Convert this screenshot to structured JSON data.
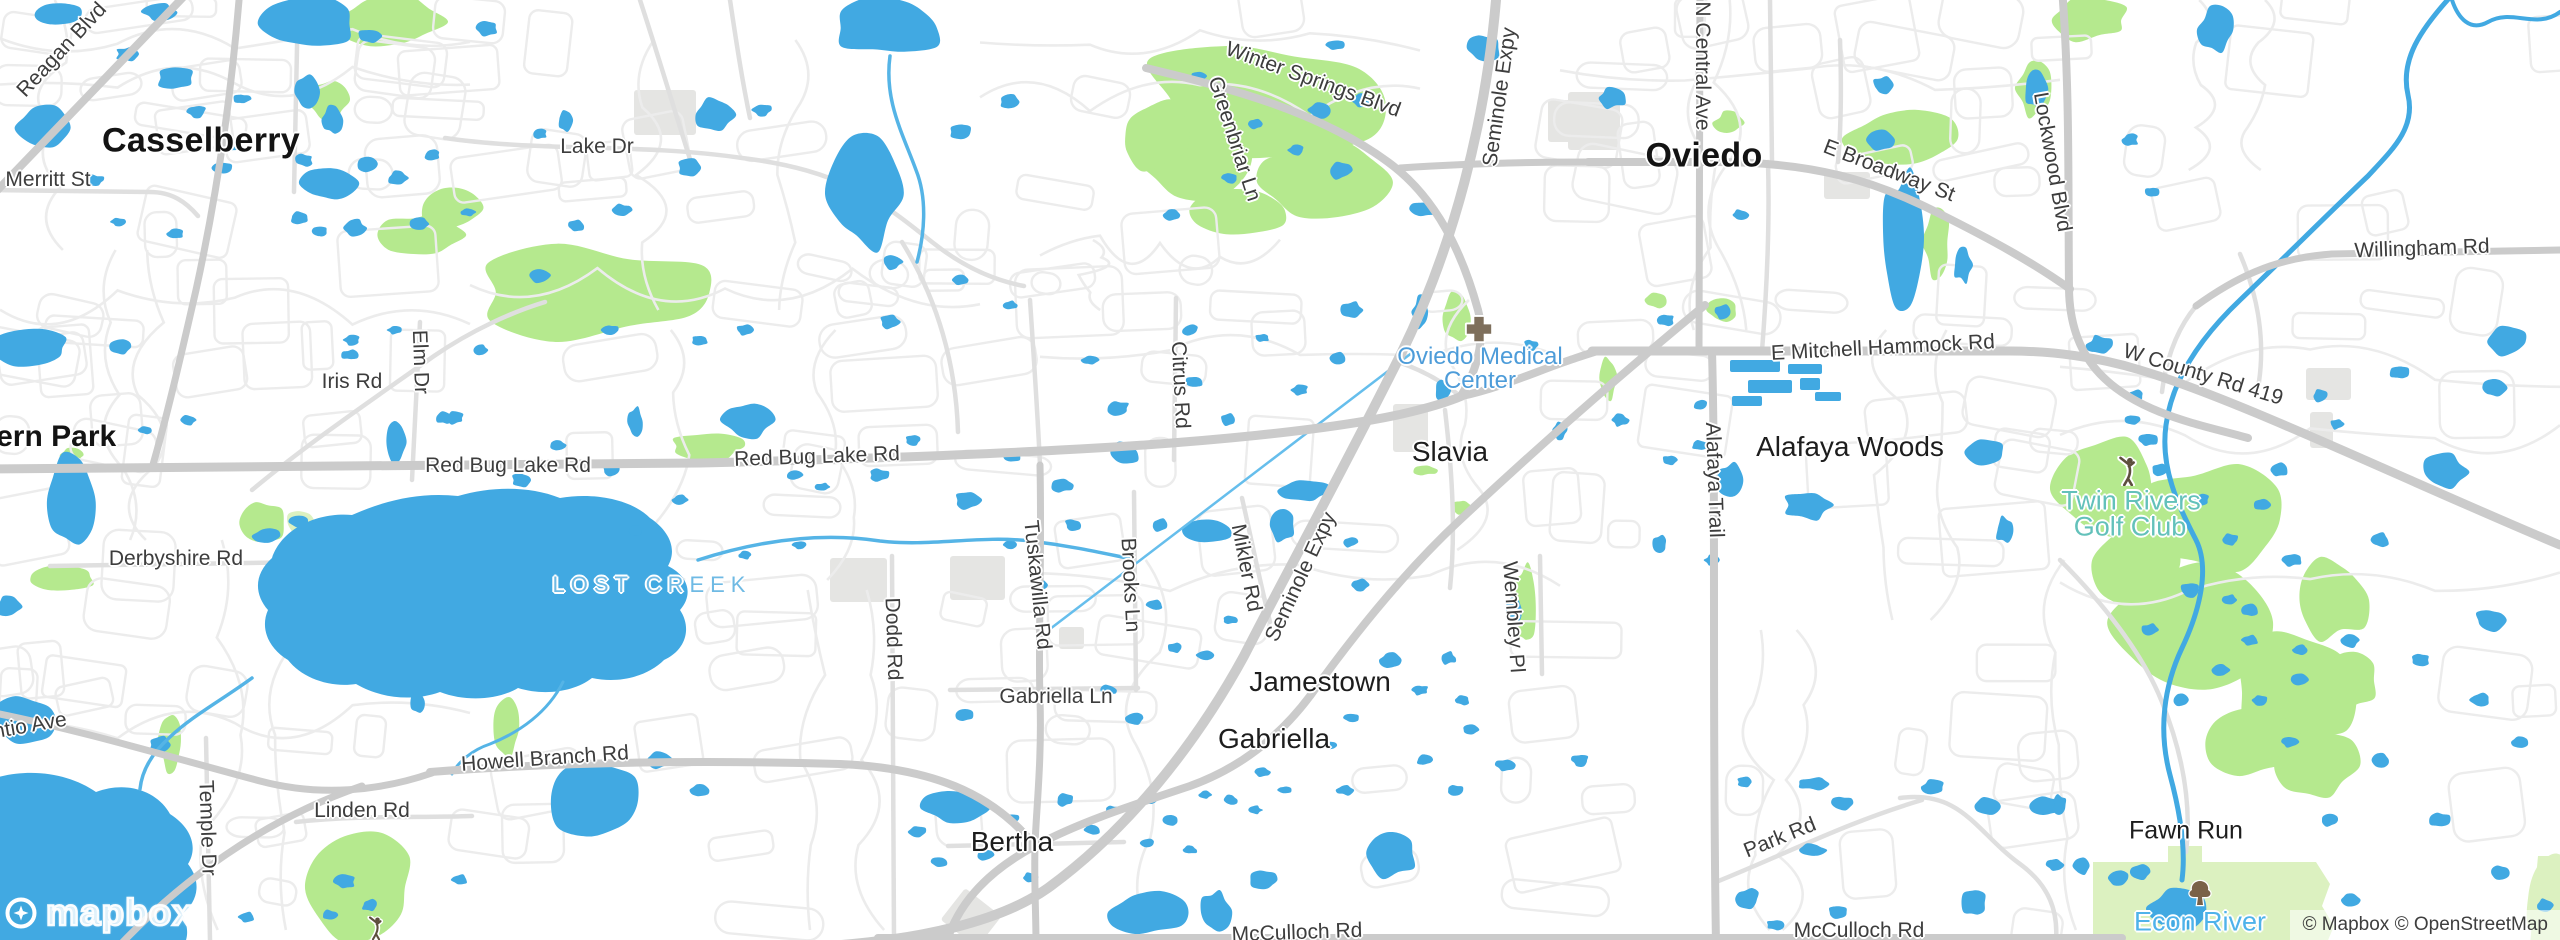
{
  "map": {
    "logo_text": "mapbox",
    "attribution": "© Mapbox © OpenStreetMap",
    "colors": {
      "land": "#ffffff",
      "water": "#41a9e2",
      "stream": "#55b4e6",
      "canal": "#66beec",
      "park": "#b5e98e",
      "park_pale": "#dcf1c0",
      "building": "#e5e5e3",
      "road_minor": "#ececec",
      "road_mid": "#dfdfdf",
      "road_major": "#cbcbcb",
      "citytext": "#131313",
      "roadtext": "#3d3d3d",
      "lostcreek": "#6fbae4",
      "econlabel": "#4fb3ea",
      "medlabel": "#4d9cd9",
      "golflabel": "#63c1ba",
      "icon_brown": "#7e6f5c",
      "tree_brown": "#7a6248",
      "golfer_brown": "#5d4f3e",
      "logo_blue": "#3fa7dd"
    },
    "labels": [
      {
        "name": "city-label-casselberry",
        "text": "Casselberry",
        "x": 201,
        "y": 141,
        "rot": 0,
        "cls": "city"
      },
      {
        "name": "city-label-oviedo",
        "text": "Oviedo",
        "x": 1704,
        "y": 156,
        "rot": 0,
        "cls": "city"
      },
      {
        "name": "city-label-fern-park",
        "text": "Fern Park",
        "x": 47,
        "y": 437,
        "rot": 0,
        "cls": "city2"
      },
      {
        "name": "town-label-slavia",
        "text": "Slavia",
        "x": 1450,
        "y": 452,
        "rot": 0,
        "cls": "town"
      },
      {
        "name": "town-label-alafaya-woods",
        "text": "Alafaya Woods",
        "x": 1850,
        "y": 447,
        "rot": 0,
        "cls": "town"
      },
      {
        "name": "town-label-jamestown",
        "text": "Jamestown",
        "x": 1320,
        "y": 682,
        "rot": 0,
        "cls": "town"
      },
      {
        "name": "town-label-gabriella",
        "text": "Gabriella",
        "x": 1274,
        "y": 739,
        "rot": 0,
        "cls": "town"
      },
      {
        "name": "town-label-bertha",
        "text": "Bertha",
        "x": 1012,
        "y": 842,
        "rot": 0,
        "cls": "town"
      },
      {
        "name": "town-label-fawn-run",
        "text": "Fawn Run",
        "x": 2186,
        "y": 831,
        "rot": 0,
        "cls": "town2"
      },
      {
        "name": "road-label-reagan-blvd",
        "text": "Reagan Blvd",
        "x": 62,
        "y": 50,
        "rot": -47,
        "cls": "road"
      },
      {
        "name": "road-label-merritt-st",
        "text": "Merritt St",
        "x": 48,
        "y": 180,
        "rot": 0,
        "cls": "road"
      },
      {
        "name": "road-label-lake-dr",
        "text": "Lake Dr",
        "x": 597,
        "y": 147,
        "rot": 0,
        "cls": "road"
      },
      {
        "name": "road-label-winter-springs-blvd",
        "text": "Winter Springs Blvd",
        "x": 1313,
        "y": 80,
        "rot": 20,
        "cls": "road"
      },
      {
        "name": "road-label-greenbriar-ln",
        "text": "Greenbriar Ln",
        "x": 1234,
        "y": 139,
        "rot": 72,
        "cls": "road"
      },
      {
        "name": "road-label-seminole-expy-north",
        "text": "Seminole Expy",
        "x": 1500,
        "y": 97,
        "rot": -82,
        "cls": "road"
      },
      {
        "name": "road-label-n-central-ave",
        "text": "N Central Ave",
        "x": 1702,
        "y": 66,
        "rot": 90,
        "cls": "road"
      },
      {
        "name": "road-label-e-broadway-st",
        "text": "E Broadway St",
        "x": 1889,
        "y": 171,
        "rot": 21,
        "cls": "road"
      },
      {
        "name": "road-label-lockwood-blvd",
        "text": "Lockwood Blvd",
        "x": 2052,
        "y": 162,
        "rot": 80,
        "cls": "road"
      },
      {
        "name": "road-label-willingham-rd",
        "text": "Willingham Rd",
        "x": 2422,
        "y": 249,
        "rot": -2,
        "cls": "road"
      },
      {
        "name": "road-label-e-mitchell-hammock-rd",
        "text": "E Mitchell Hammock Rd",
        "x": 1883,
        "y": 348,
        "rot": -3,
        "cls": "road"
      },
      {
        "name": "road-label-w-county-rd-419",
        "text": "W County Rd 419",
        "x": 2203,
        "y": 375,
        "rot": 17,
        "cls": "road"
      },
      {
        "name": "road-label-red-bug-lake-rd-west",
        "text": "Red Bug Lake Rd",
        "x": 508,
        "y": 466,
        "rot": 0,
        "cls": "road"
      },
      {
        "name": "road-label-red-bug-lake-rd-east",
        "text": "Red Bug Lake Rd",
        "x": 817,
        "y": 457,
        "rot": -2,
        "cls": "road"
      },
      {
        "name": "road-label-iris-rd",
        "text": "Iris Rd",
        "x": 352,
        "y": 382,
        "rot": 0,
        "cls": "road"
      },
      {
        "name": "road-label-elm-dr",
        "text": "Elm Dr",
        "x": 420,
        "y": 362,
        "rot": 88,
        "cls": "road"
      },
      {
        "name": "road-label-derbyshire-rd",
        "text": "Derbyshire Rd",
        "x": 176,
        "y": 559,
        "rot": 0,
        "cls": "road"
      },
      {
        "name": "road-label-citrus-rd",
        "text": "Citrus Rd",
        "x": 1180,
        "y": 385,
        "rot": 87,
        "cls": "road"
      },
      {
        "name": "road-label-tuskawilla-rd",
        "text": "Tuskawilla Rd",
        "x": 1037,
        "y": 585,
        "rot": 84,
        "cls": "road"
      },
      {
        "name": "road-label-brooks-ln",
        "text": "Brooks Ln",
        "x": 1130,
        "y": 585,
        "rot": 87,
        "cls": "road"
      },
      {
        "name": "road-label-mikler-rd",
        "text": "Mikler Rd",
        "x": 1246,
        "y": 568,
        "rot": 79,
        "cls": "road"
      },
      {
        "name": "road-label-seminole-expy-mid",
        "text": "Seminole Expy",
        "x": 1301,
        "y": 577,
        "rot": -65,
        "cls": "road"
      },
      {
        "name": "road-label-dodd-rd",
        "text": "Dodd Rd",
        "x": 893,
        "y": 639,
        "rot": 88,
        "cls": "road"
      },
      {
        "name": "road-label-wembley-pl",
        "text": "Wembley Pl",
        "x": 1513,
        "y": 617,
        "rot": 86,
        "cls": "road"
      },
      {
        "name": "road-label-gabriella-ln",
        "text": "Gabriella Ln",
        "x": 1056,
        "y": 697,
        "rot": 0,
        "cls": "road"
      },
      {
        "name": "road-label-howell-branch-rd",
        "text": "Howell Branch Rd",
        "x": 545,
        "y": 759,
        "rot": -4,
        "cls": "road"
      },
      {
        "name": "road-label-ntio-ave",
        "text": "ntio Ave",
        "x": 30,
        "y": 726,
        "rot": -10,
        "cls": "road"
      },
      {
        "name": "road-label-linden-rd",
        "text": "Linden Rd",
        "x": 362,
        "y": 811,
        "rot": 0,
        "cls": "road"
      },
      {
        "name": "road-label-temple-dr",
        "text": "Temple Dr",
        "x": 207,
        "y": 828,
        "rot": 88,
        "cls": "road"
      },
      {
        "name": "road-label-alafaya-trail",
        "text": "Alafaya Trail",
        "x": 1714,
        "y": 480,
        "rot": 88,
        "cls": "road"
      },
      {
        "name": "road-label-park-rd",
        "text": "Park Rd",
        "x": 1780,
        "y": 838,
        "rot": -22,
        "cls": "road"
      },
      {
        "name": "road-label-mcculloch-rd-west",
        "text": "McCulloch Rd",
        "x": 1297,
        "y": 933,
        "rot": -2,
        "cls": "road"
      },
      {
        "name": "road-label-mcculloch-rd-east",
        "text": "McCulloch Rd",
        "x": 1859,
        "y": 931,
        "rot": 0,
        "cls": "road"
      },
      {
        "name": "water-label-lost-creek",
        "text": "LOST CREEK",
        "x": 652,
        "y": 585,
        "rot": 0,
        "cls": "watercaps"
      },
      {
        "name": "water-label-econ-river",
        "text": "Econ River",
        "x": 2200,
        "y": 922,
        "rot": 0,
        "cls": "waterpoi"
      },
      {
        "name": "poi-label-oviedo-medical-line1",
        "text": "Oviedo Medical",
        "x": 1480,
        "y": 357,
        "rot": 0,
        "cls": "poimed"
      },
      {
        "name": "poi-label-oviedo-medical-line2",
        "text": "Center",
        "x": 1480,
        "y": 381,
        "rot": 0,
        "cls": "poimed"
      },
      {
        "name": "poi-label-twin-rivers-line1",
        "text": "Twin Rivers",
        "x": 2131,
        "y": 501,
        "rot": 0,
        "cls": "poigolf"
      },
      {
        "name": "poi-label-twin-rivers-line2",
        "text": "Golf Club",
        "x": 2130,
        "y": 527,
        "rot": 0,
        "cls": "poigolf"
      }
    ],
    "icons": [
      {
        "name": "hospital-cross-icon",
        "x": 1479,
        "y": 329,
        "size": 30,
        "sym": "cross"
      },
      {
        "name": "golfer-icon-twin-rivers",
        "x": 2128,
        "y": 471,
        "size": 30,
        "sym": "golfer"
      },
      {
        "name": "golfer-icon-linden-park",
        "x": 376,
        "y": 928,
        "size": 24,
        "sym": "golfer"
      },
      {
        "name": "tree-icon-econ-river",
        "x": 2200,
        "y": 893,
        "size": 32,
        "sym": "tree"
      }
    ]
  }
}
